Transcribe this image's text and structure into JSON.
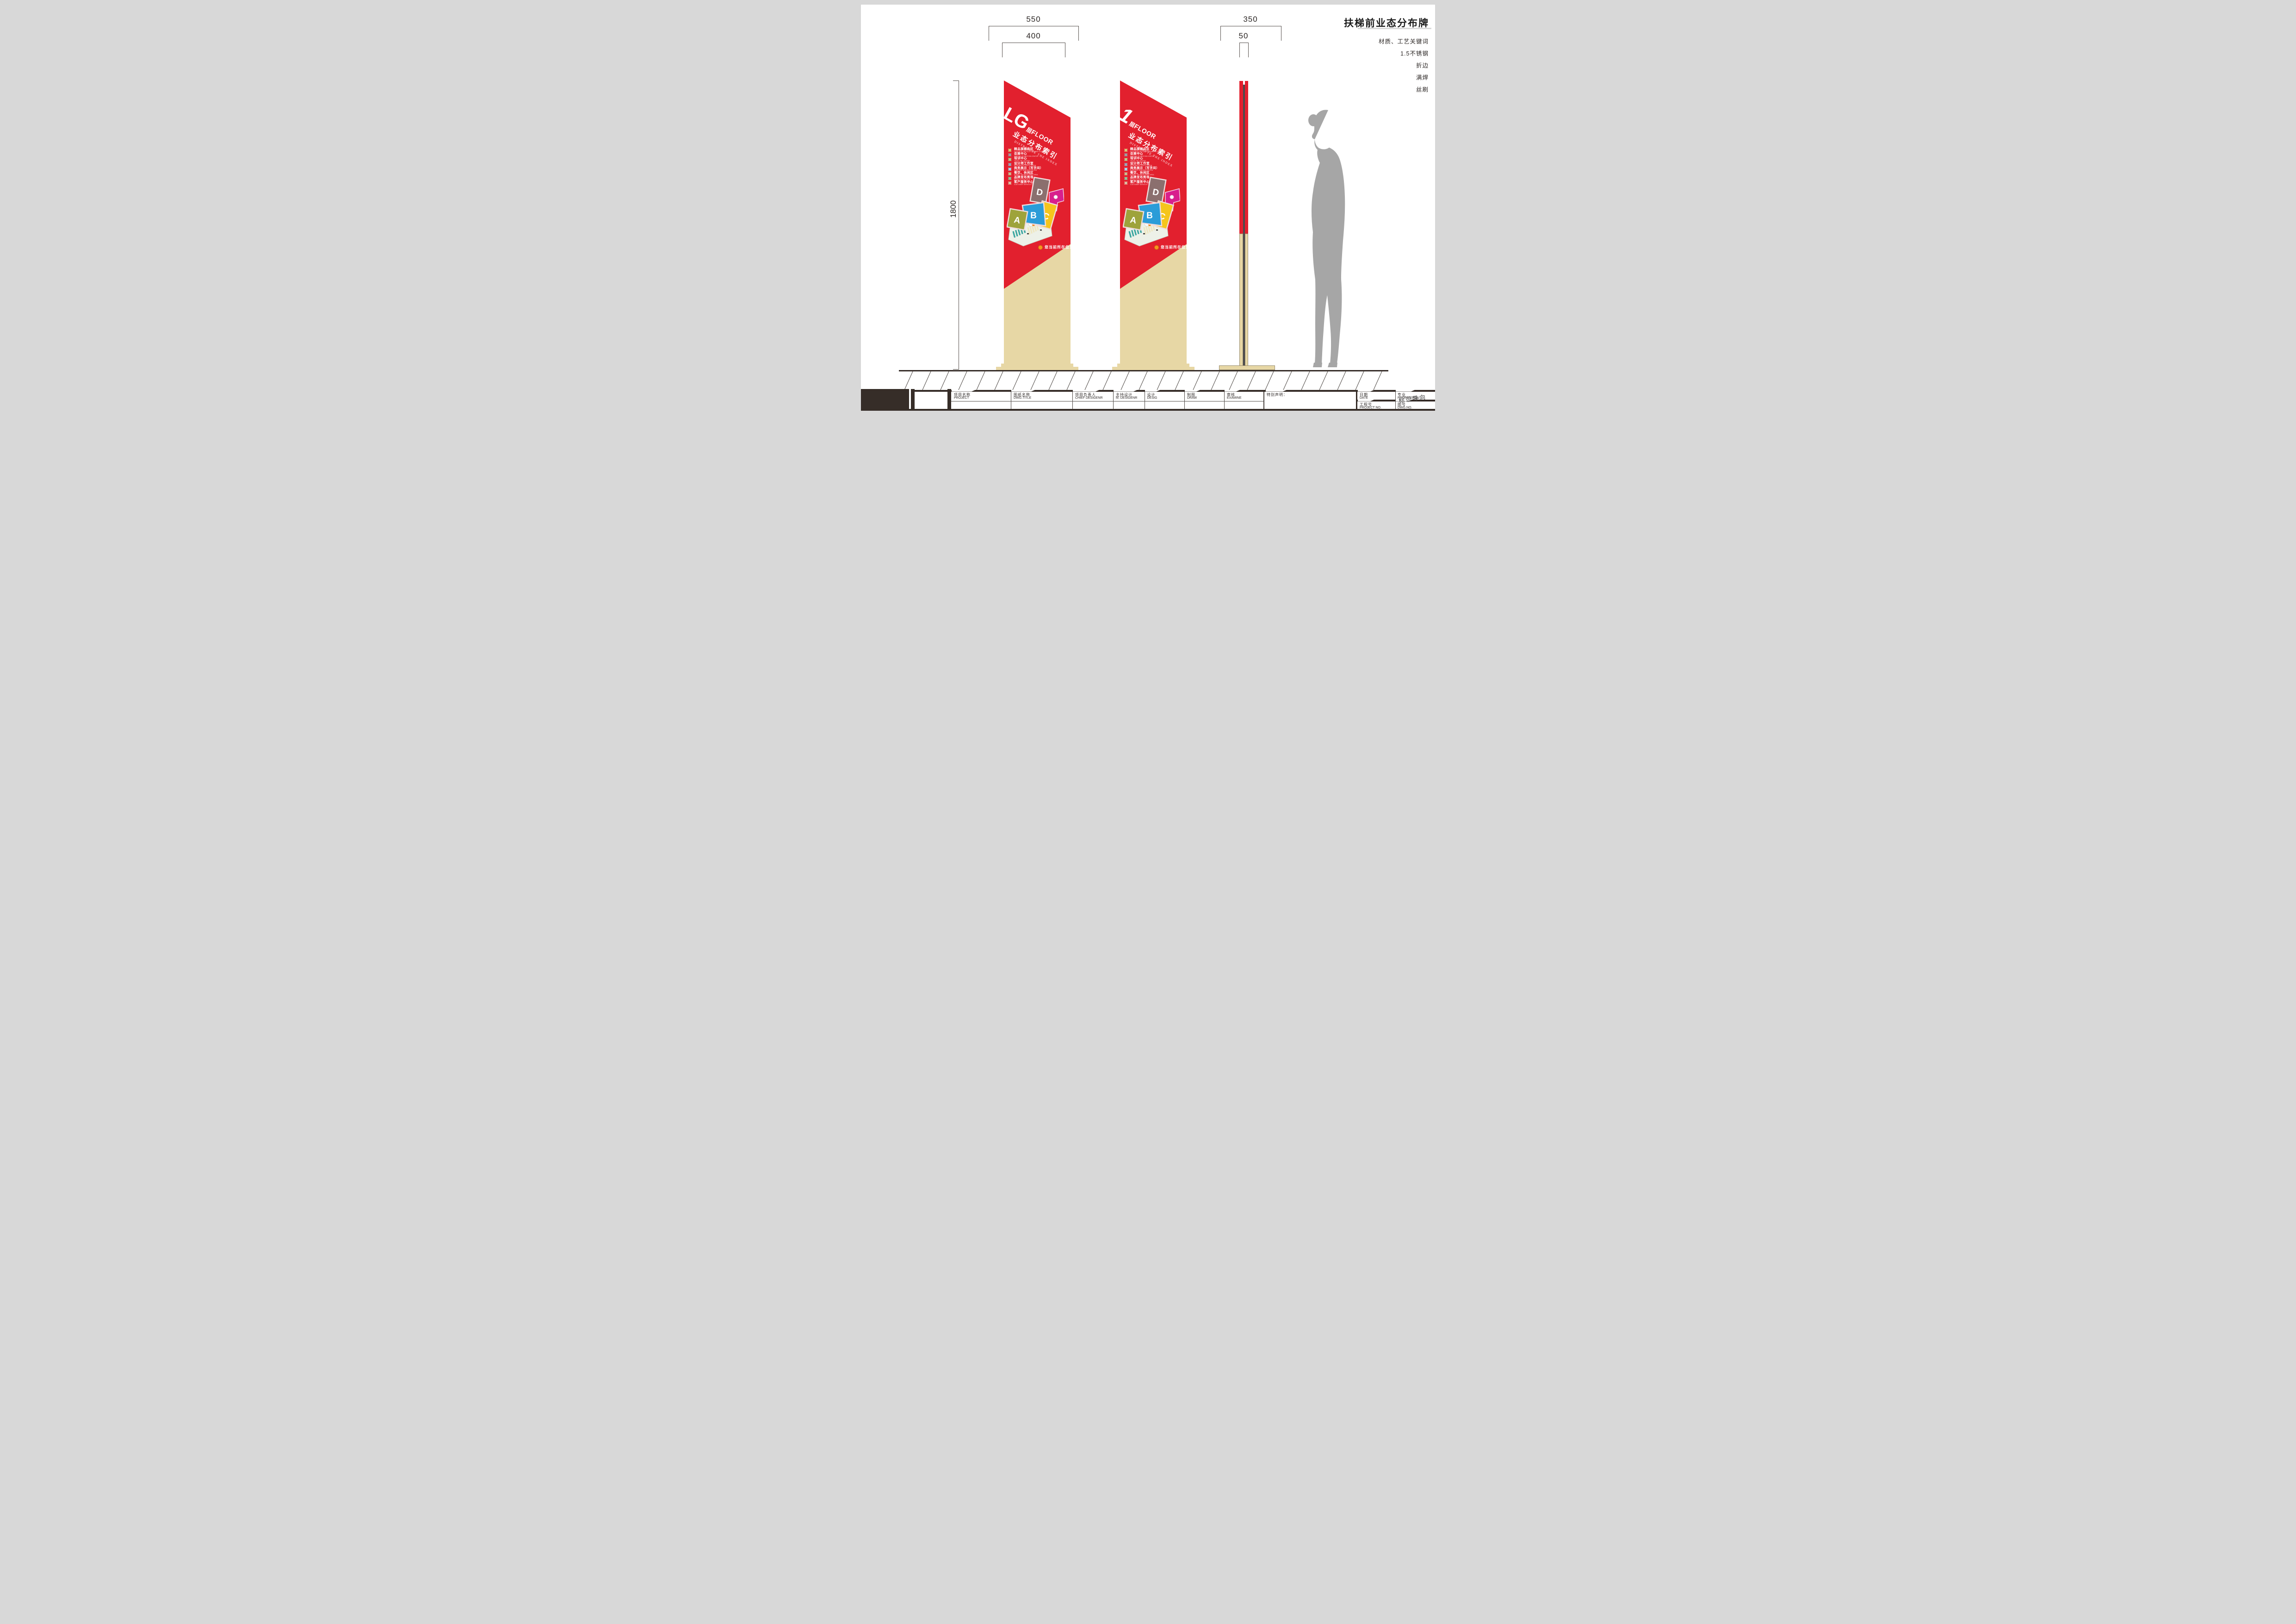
{
  "page": {
    "title": "扶梯前业态分布牌"
  },
  "notes": {
    "material_title": "材质、工艺关键词",
    "materials": [
      "1.5不锈钢",
      "折边",
      "满焊",
      "丝刷"
    ]
  },
  "dimensions": {
    "total_width": "550",
    "panel_width": "400",
    "side_depth": "350",
    "side_thickness": "50",
    "height": "1800"
  },
  "legend": [
    {
      "zh": "精品旗舰店区",
      "en": "EXQUISITE ARTICLE FLAGSHIP STORE",
      "color": "#d8c77c"
    },
    {
      "zh": "会展中心",
      "en": "MEETING EXHIBITION CENTER",
      "color": "#9d9da2"
    },
    {
      "zh": "培训中心",
      "en": "TRAIN THE CENTER",
      "color": "#b8cb90"
    },
    {
      "zh": "设计师工作室",
      "en": "DESIGNER'S UTILITY ROOM",
      "color": "#9aa6b8"
    },
    {
      "zh": "商务展示（写字间）",
      "en": "BUSINESS DEMONSTRATION",
      "color": "#a9d6ec"
    },
    {
      "zh": "餐饮、休闲区",
      "en": "DINING, RECREATIONAL AREA",
      "color": "#c8bf90"
    },
    {
      "zh": "品牌发布秀场",
      "en": "BRAND SHOW FIELD",
      "color": "#90c49c"
    },
    {
      "zh": "客户服务中心",
      "en": "CUSTOMER SERVICE CENTER",
      "color": "#dcbba1"
    }
  ],
  "signs": [
    {
      "floor": "LG",
      "floor_zh": "层",
      "floor_en": "FLOOR",
      "title": "业态分布索引",
      "subtitle": "DISTRIBUTE THE INDEX",
      "location_note": "您当前所在位置"
    },
    {
      "floor": "1",
      "floor_zh": "层",
      "floor_en": "FLOOR",
      "title": "业态分布索引",
      "subtitle": "DISTRIBUTE THE INDEX",
      "location_note": "您当前所在位置"
    }
  ],
  "map": {
    "blocks": [
      {
        "label": "A",
        "color": "#9ea33b"
      },
      {
        "label": "B",
        "color": "#2b9cd8"
      },
      {
        "label": "C",
        "color": "#f5c51c"
      },
      {
        "label": "D",
        "color": "#8b6f6e"
      }
    ],
    "wing_color": "#d81f8d"
  },
  "title_block": {
    "fields": [
      {
        "zh": "项目名称",
        "en": "PROJECT"
      },
      {
        "zh": "图纸名称",
        "en": "DWG.TITLE"
      },
      {
        "zh": "项目负责人",
        "en": "CHIEF DESIGENR"
      },
      {
        "zh": "主持设计",
        "en": "M. DESIGENR"
      },
      {
        "zh": "设计",
        "en": "DESIG"
      },
      {
        "zh": "制图",
        "en": "DRAW"
      },
      {
        "zh": "审核",
        "en": "EXAMINE"
      }
    ],
    "special_note": "特别声明：",
    "date": {
      "zh": "日期",
      "en": "DATE"
    },
    "profession": {
      "zh": "专业",
      "en": "PROFESSION"
    },
    "project_no": {
      "zh": "工程号",
      "en": "PROJECT NO."
    },
    "dwg_no": {
      "zh": "图号",
      "en": "DWG.NO."
    },
    "stamp": "标识导向"
  },
  "colors": {
    "sign_red": "#e2202e",
    "base_beige": "#e7d7a5",
    "titleblock_dark": "#362d28",
    "silhouette_gray": "#a6a6a6",
    "location_orange": "#f7941e"
  }
}
